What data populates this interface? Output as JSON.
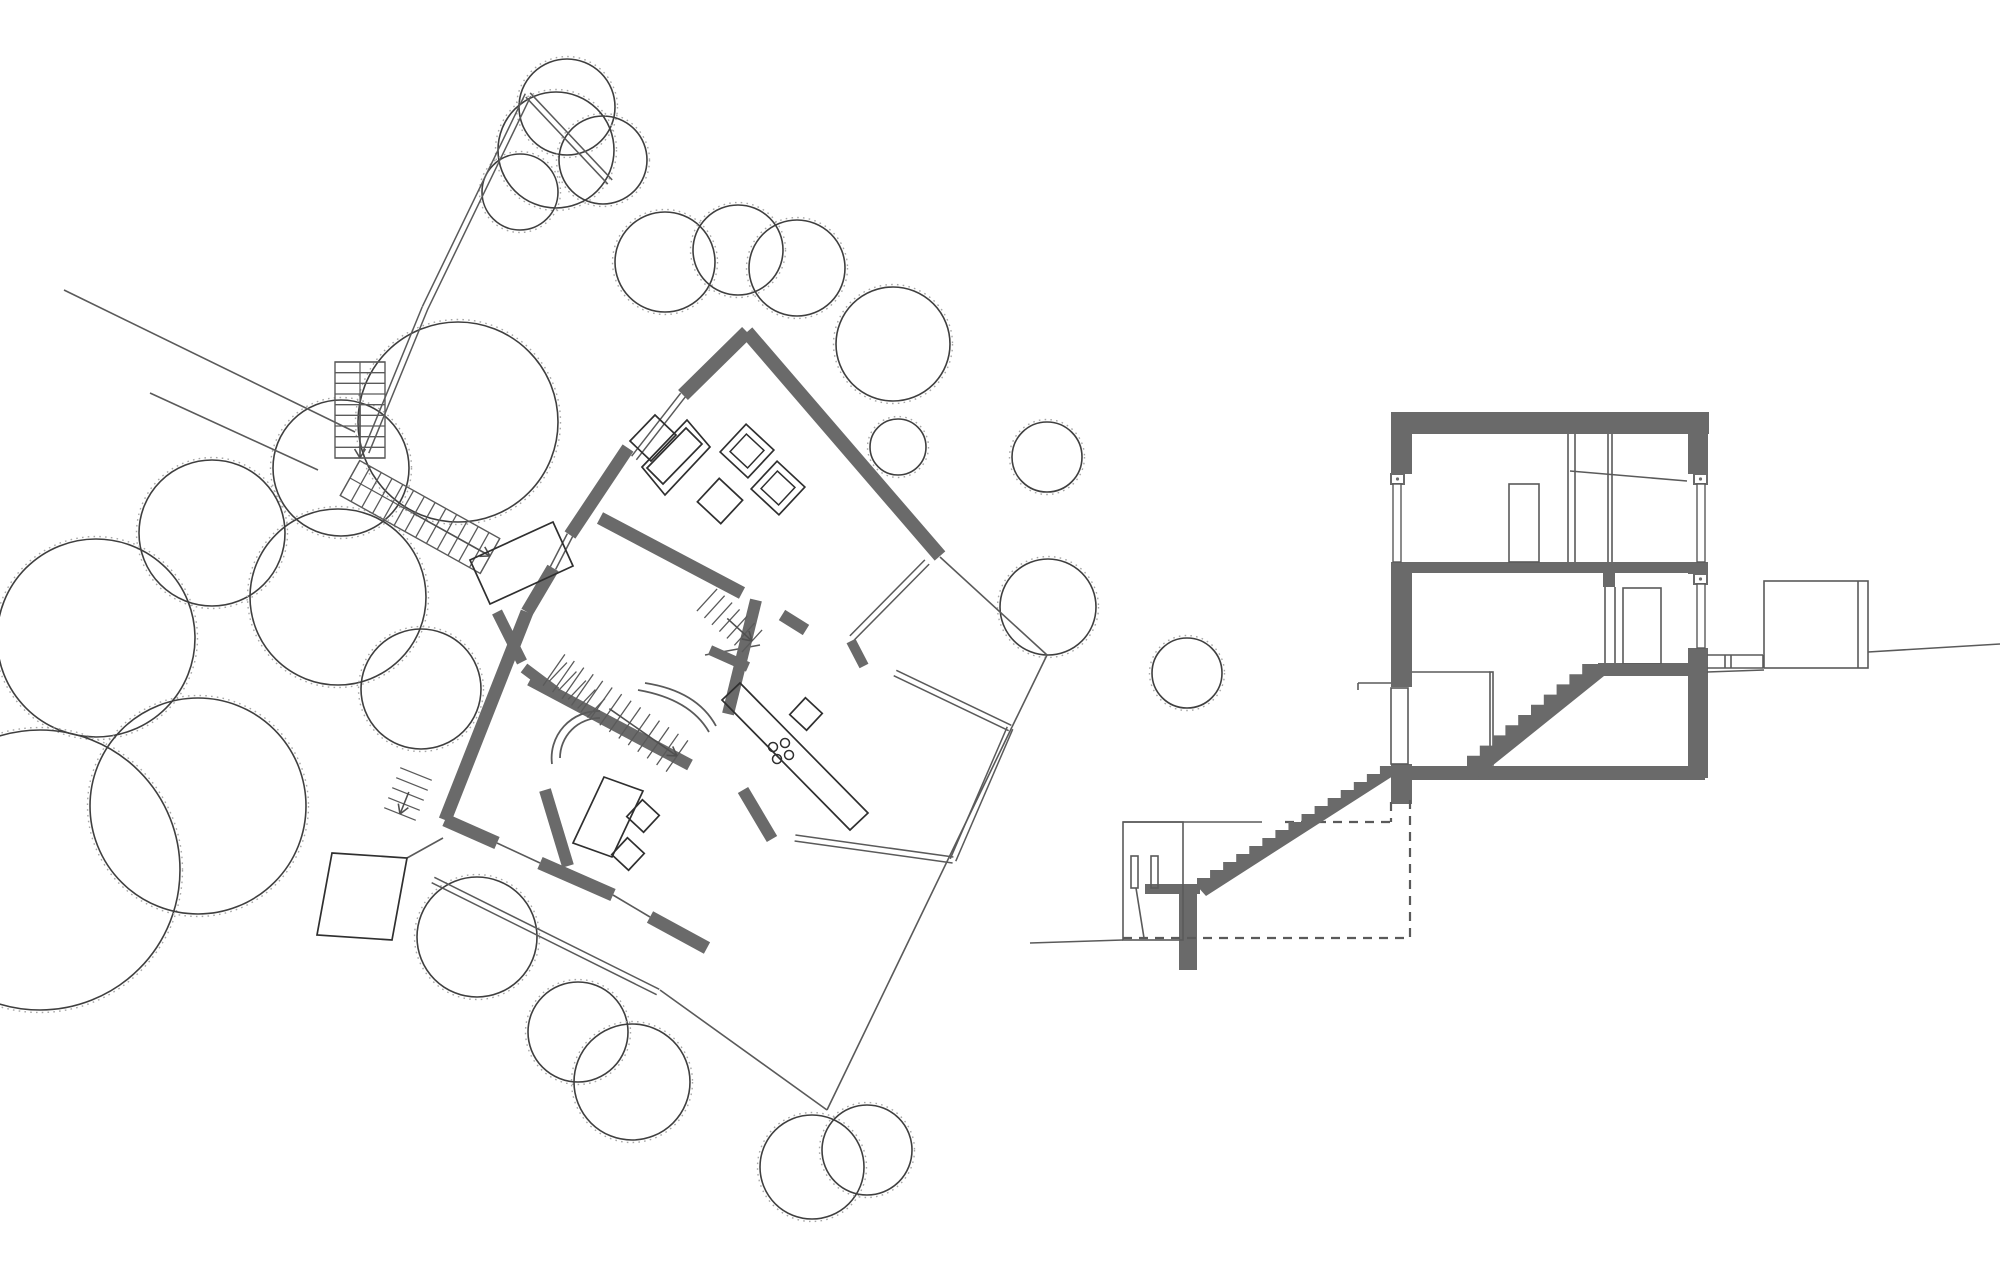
{
  "canvas": {
    "w": 2000,
    "h": 1284,
    "background": "#ffffff"
  },
  "colors": {
    "wall": "#6a6a6a",
    "line": "#505050",
    "thin": "#5a5a5a",
    "tree": "#3f3f3f",
    "speckle": "#a8a8a8",
    "dash": "#5a5a5a",
    "furniture": "#2f2f2f"
  },
  "plan": {
    "trees": [
      [
        567,
        107,
        48
      ],
      [
        603,
        160,
        44
      ],
      [
        556,
        150,
        58
      ],
      [
        520,
        192,
        38
      ],
      [
        665,
        262,
        50
      ],
      [
        738,
        250,
        45
      ],
      [
        797,
        268,
        48
      ],
      [
        893,
        344,
        57
      ],
      [
        898,
        447,
        28
      ],
      [
        1047,
        457,
        35
      ],
      [
        1048,
        607,
        48
      ],
      [
        1187,
        673,
        35
      ],
      [
        341,
        468,
        68
      ],
      [
        458,
        422,
        100
      ],
      [
        212,
        533,
        73
      ],
      [
        338,
        597,
        88
      ],
      [
        96,
        638,
        99
      ],
      [
        40,
        870,
        140
      ],
      [
        198,
        806,
        108
      ],
      [
        421,
        689,
        60
      ],
      [
        477,
        937,
        60
      ],
      [
        578,
        1032,
        50
      ],
      [
        632,
        1082,
        58
      ],
      [
        812,
        1167,
        52
      ],
      [
        867,
        1150,
        45
      ]
    ],
    "thick_walls": [
      [
        747,
        332,
        940,
        556,
        14
      ],
      [
        747,
        332,
        683,
        395,
        14
      ],
      [
        628,
        448,
        570,
        535,
        13
      ],
      [
        553,
        568,
        527,
        612,
        13
      ],
      [
        527,
        612,
        445,
        820,
        13
      ],
      [
        445,
        820,
        497,
        843,
        13
      ],
      [
        540,
        863,
        613,
        895,
        13
      ],
      [
        650,
        917,
        707,
        948,
        13
      ],
      [
        600,
        518,
        742,
        593,
        13
      ],
      [
        782,
        615,
        806,
        630,
        12
      ],
      [
        756,
        600,
        728,
        714,
        12
      ],
      [
        530,
        680,
        690,
        765,
        12
      ],
      [
        545,
        790,
        568,
        866,
        12
      ],
      [
        743,
        790,
        772,
        839,
        12
      ],
      [
        851,
        641,
        864,
        666,
        10
      ],
      [
        710,
        650,
        748,
        667,
        10
      ],
      [
        497,
        612,
        522,
        662,
        11
      ],
      [
        524,
        668,
        556,
        692,
        11
      ]
    ],
    "thin_lines": [
      [
        64,
        290,
        355,
        432
      ],
      [
        150,
        393,
        318,
        470
      ],
      [
        940,
        557,
        1047,
        655
      ],
      [
        1047,
        655,
        1012,
        727
      ],
      [
        1012,
        727,
        827,
        1110
      ],
      [
        660,
        990,
        827,
        1110
      ],
      [
        497,
        843,
        540,
        863
      ],
      [
        613,
        895,
        650,
        917
      ],
      [
        705,
        655,
        760,
        645
      ],
      [
        407,
        858,
        443,
        838
      ]
    ],
    "double_lines": [
      [
        683,
        395,
        634,
        458
      ],
      [
        570,
        535,
        553,
        568
      ],
      [
        927,
        562,
        852,
        638
      ],
      [
        895,
        673,
        1010,
        728
      ],
      [
        1010,
        728,
        953,
        860
      ],
      [
        953,
        860,
        795,
        838
      ],
      [
        433,
        880,
        658,
        992
      ],
      [
        528,
        95,
        425,
        308
      ],
      [
        425,
        308,
        366,
        452
      ],
      [
        528,
        95,
        610,
        182
      ]
    ],
    "quads": [
      [
        [
          573,
          843
        ],
        [
          604,
          777
        ],
        [
          643,
          791
        ],
        [
          612,
          857
        ]
      ],
      [
        [
          722,
          700
        ],
        [
          740,
          683
        ],
        [
          868,
          813
        ],
        [
          850,
          830
        ]
      ],
      [
        [
          470,
          560
        ],
        [
          553,
          522
        ],
        [
          573,
          566
        ],
        [
          490,
          604
        ]
      ],
      [
        [
          332,
          853
        ],
        [
          407,
          858
        ],
        [
          392,
          940
        ],
        [
          317,
          935
        ]
      ],
      [
        [
          642,
          467
        ],
        [
          687,
          420
        ],
        [
          710,
          447
        ],
        [
          665,
          495
        ]
      ],
      [
        [
          647,
          468
        ],
        [
          686,
          428
        ],
        [
          702,
          444
        ],
        [
          663,
          484
        ]
      ],
      [
        [
          630,
          441
        ],
        [
          655,
          415
        ],
        [
          676,
          435
        ],
        [
          651,
          461
        ]
      ]
    ],
    "rot_squares": [
      {
        "cx": 747,
        "cy": 451,
        "size": 38,
        "angle": -47,
        "inner": 24
      },
      {
        "cx": 778,
        "cy": 488,
        "size": 38,
        "angle": -47,
        "inner": 24
      },
      {
        "cx": 720,
        "cy": 501,
        "size": 32,
        "angle": -47,
        "inner": 0
      },
      {
        "cx": 643,
        "cy": 816,
        "size": 23,
        "angle": 43,
        "inner": 0
      },
      {
        "cx": 628,
        "cy": 854,
        "size": 23,
        "angle": 43,
        "inner": 0
      },
      {
        "cx": 806,
        "cy": 714,
        "size": 23,
        "angle": 43,
        "inner": 0
      }
    ],
    "hob_circles": [
      [
        773,
        747
      ],
      [
        785,
        743
      ],
      [
        777,
        759
      ],
      [
        789,
        755
      ]
    ],
    "hob_radius": 4.5,
    "arcs": [
      "M 560 758 A 40 40 0 0 1 600 718",
      "M 552 764 A 47 47 0 0 1 600 711",
      "M 645 683 Q 697 691 716 726",
      "M 638 690 Q 690 699 709 732"
    ],
    "stairs": [
      {
        "cl": [
          360,
          362,
          360,
          458
        ],
        "w": 50,
        "n": 9,
        "outline": true,
        "divider": true,
        "arrow": true
      },
      {
        "cl": [
          350,
          478,
          490,
          556
        ],
        "w": 40,
        "n": 13,
        "outline": true,
        "divider": true,
        "arrow": true
      },
      {
        "cl": [
          554,
          670,
          677,
          756
        ],
        "w": 38,
        "n": 13,
        "outline": false,
        "divider": false,
        "arrow": true
      },
      {
        "cl": [
          707,
          600,
          752,
          641
        ],
        "w": 30,
        "n": 6,
        "outline": false,
        "divider": false,
        "arrow": true
      },
      {
        "cl": [
          416,
          774,
          400,
          814
        ],
        "w": 34,
        "n": 4,
        "outline": false,
        "divider": false,
        "arrow": true
      },
      {
        "cl": [
          558,
          672,
          596,
          708
        ],
        "w": 26,
        "n": 4,
        "outline": false,
        "divider": false,
        "arrow": false
      }
    ]
  },
  "section": {
    "fill_rects": [
      [
        1391,
        412,
        318,
        22
      ],
      [
        1391,
        434,
        21,
        40
      ],
      [
        1391,
        562,
        21,
        125
      ],
      [
        1391,
        764,
        21,
        40
      ],
      [
        1688,
        434,
        20,
        40
      ],
      [
        1688,
        562,
        20,
        12
      ],
      [
        1688,
        648,
        20,
        130
      ],
      [
        1412,
        562,
        276,
        11
      ],
      [
        1403,
        766,
        302,
        14
      ],
      [
        1598,
        663,
        90,
        11
      ],
      [
        1603,
        570,
        12,
        17
      ],
      [
        1145,
        884,
        55,
        10
      ],
      [
        1179,
        894,
        18,
        76
      ]
    ],
    "fittings": [
      [
        1391,
        474,
        13,
        10
      ],
      [
        1694,
        474,
        13,
        10
      ],
      [
        1694,
        574,
        13,
        10
      ]
    ],
    "pane_rects": [
      [
        1393,
        484,
        8,
        78
      ],
      [
        1697,
        484,
        8,
        78
      ],
      [
        1697,
        584,
        8,
        64
      ]
    ],
    "outline_rects": [
      [
        1509,
        484,
        30,
        78
      ],
      [
        1623,
        588,
        38,
        76
      ],
      [
        1391,
        688,
        17,
        76
      ],
      [
        1764,
        581,
        104,
        87
      ],
      [
        1123,
        822,
        60,
        118
      ],
      [
        1131,
        856,
        7,
        32
      ],
      [
        1151,
        856,
        7,
        32
      ],
      [
        1490,
        672,
        3,
        93
      ]
    ],
    "thin_lines": [
      [
        1568,
        434,
        1568,
        562
      ],
      [
        1575,
        434,
        1575,
        562
      ],
      [
        1608,
        434,
        1608,
        562
      ],
      [
        1612,
        434,
        1612,
        562
      ],
      [
        1570,
        471,
        1687,
        481
      ],
      [
        1605,
        587,
        1605,
        663
      ],
      [
        1615,
        587,
        1615,
        663
      ],
      [
        1412,
        672,
        1490,
        672
      ],
      [
        1358,
        683,
        1391,
        683
      ],
      [
        1358,
        683,
        1358,
        690
      ],
      [
        1707,
        655,
        1763,
        655
      ],
      [
        1707,
        668,
        1763,
        668
      ],
      [
        1725,
        655,
        1725,
        668
      ],
      [
        1731,
        655,
        1731,
        668
      ],
      [
        1763,
        655,
        1763,
        668
      ],
      [
        1858,
        581,
        1858,
        668
      ],
      [
        1868,
        652,
        2000,
        644
      ],
      [
        1707,
        672,
        1764,
        670
      ],
      [
        1030,
        943,
        1123,
        940
      ],
      [
        1123,
        822,
        1262,
        822
      ],
      [
        1136,
        888,
        1144,
        938
      ]
    ],
    "dash_lines": [
      [
        1410,
        800,
        1410,
        938
      ],
      [
        1123,
        938,
        1410,
        938
      ],
      [
        1285,
        822,
        1391,
        822
      ],
      [
        1391,
        802,
        1391,
        822
      ]
    ],
    "stair_polys": [
      {
        "x1": 1467,
        "y1": 766,
        "x2": 1595,
        "y2": 664,
        "n": 10,
        "ext": [
          [
            1688,
            664
          ],
          [
            1688,
            676
          ],
          [
            1604,
            676
          ],
          [
            1477,
            778
          ]
        ]
      },
      {
        "x1": 1197,
        "y1": 886,
        "x2": 1393,
        "y2": 766,
        "n": 15,
        "ext": [
          [
            1393,
            776
          ],
          [
            1206,
            896
          ]
        ]
      }
    ]
  }
}
